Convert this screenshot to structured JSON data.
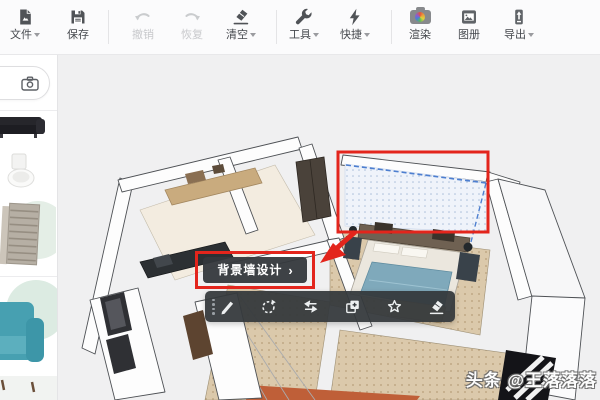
{
  "toolbar": {
    "items": [
      {
        "label": "文件",
        "icon": "file-icon",
        "enabled": true,
        "has_dropdown": true
      },
      {
        "label": "保存",
        "icon": "save-icon",
        "enabled": true,
        "has_dropdown": false
      },
      {
        "label": "撤销",
        "icon": "undo-icon",
        "enabled": false,
        "has_dropdown": false
      },
      {
        "label": "恢复",
        "icon": "redo-icon",
        "enabled": false,
        "has_dropdown": false
      },
      {
        "label": "清空",
        "icon": "clear-eraser-icon",
        "enabled": true,
        "has_dropdown": true
      },
      {
        "label": "工具",
        "icon": "wrench-icon",
        "enabled": true,
        "has_dropdown": true
      },
      {
        "label": "快捷",
        "icon": "lightning-icon",
        "enabled": true,
        "has_dropdown": true
      },
      {
        "label": "渲染",
        "icon": "render-camera-icon",
        "enabled": true,
        "has_dropdown": false
      },
      {
        "label": "图册",
        "icon": "album-icon",
        "enabled": true,
        "has_dropdown": false
      },
      {
        "label": "导出",
        "icon": "export-icon",
        "enabled": true,
        "has_dropdown": true
      }
    ]
  },
  "sidebar": {
    "camera_search_icon": "camera-icon",
    "catalog_items": [
      {
        "name": "dark-sofa-thumbnail"
      },
      {
        "name": "toilet-thumbnail"
      },
      {
        "name": "cabinet-thumbnail"
      },
      {
        "name": "teal-sofa-thumbnail"
      }
    ]
  },
  "viewport": {
    "selected_object": "bedroom-background-wall",
    "annotation_color": "#e3251c",
    "selection_dash_color": "#4d7fd0"
  },
  "context_button": {
    "label": "背景墙设计",
    "chevron": "›"
  },
  "context_toolbar": {
    "icons": [
      "edit-pencil",
      "rotate",
      "mirror-flip",
      "copy-add",
      "favorite-star",
      "erase-delete"
    ]
  },
  "watermark": {
    "text": "头条 @王落落落"
  },
  "colors": {
    "annotation_red": "#e3251c",
    "selection_blue": "#4d7fd0",
    "toolbar_dark": "#34383c",
    "floor_beige": "#dbc9ab",
    "floor_orange": "#bf5f38",
    "blanket_teal": "#7fa9bb",
    "canvas_gray": "#f0f0f1"
  }
}
